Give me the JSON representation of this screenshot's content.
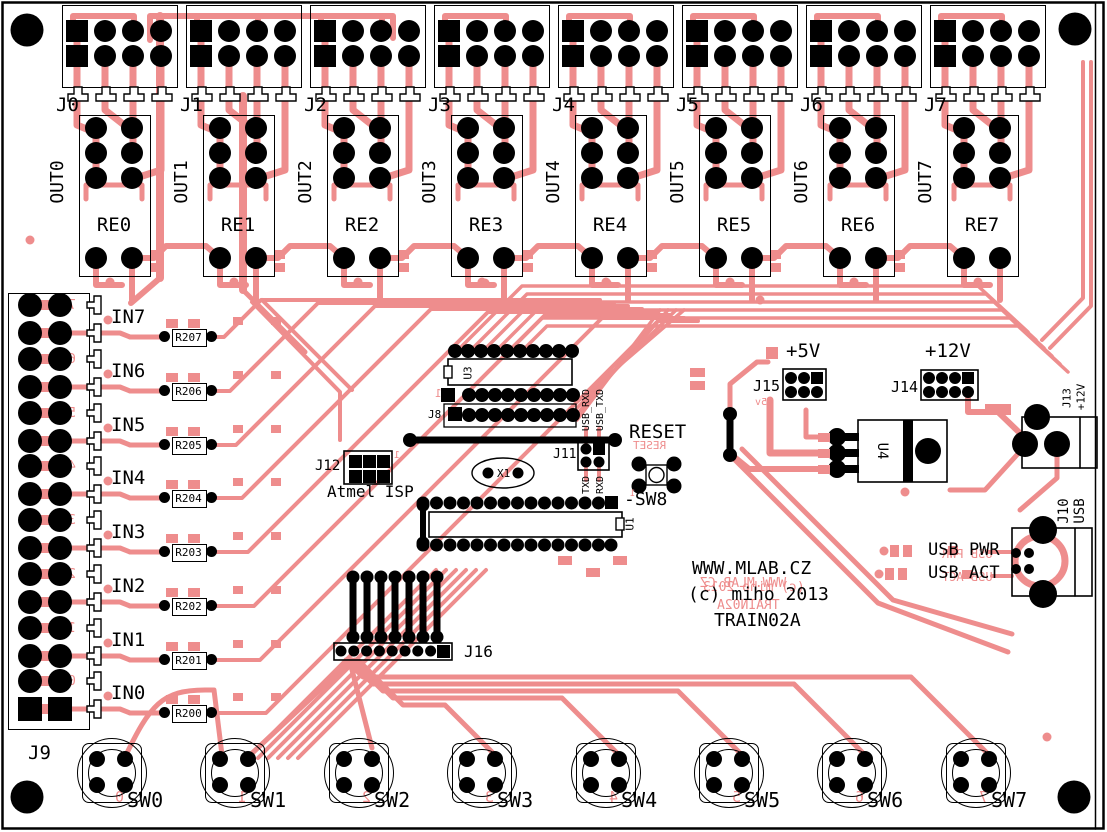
{
  "title_block": {
    "line1": "WWW.MLAB.CZ",
    "line2": "(c) miho 2013",
    "line3": "TRAIN02A"
  },
  "colors": {
    "copper": "#ee8d8d",
    "silkscreen": "#000000",
    "background": "#ffffff"
  },
  "output_channels": [
    {
      "connector": "J0",
      "net": "OUT0",
      "relay": "RE0"
    },
    {
      "connector": "J1",
      "net": "OUT1",
      "relay": "RE1"
    },
    {
      "connector": "J2",
      "net": "OUT2",
      "relay": "RE2"
    },
    {
      "connector": "J3",
      "net": "OUT3",
      "relay": "RE3"
    },
    {
      "connector": "J4",
      "net": "OUT4",
      "relay": "RE4"
    },
    {
      "connector": "J5",
      "net": "OUT5",
      "relay": "RE5"
    },
    {
      "connector": "J6",
      "net": "OUT6",
      "relay": "RE6"
    },
    {
      "connector": "J7",
      "net": "OUT7",
      "relay": "RE7"
    }
  ],
  "input_channels": [
    {
      "net": "IN7",
      "resistor": "R207",
      "pin_digit": "7"
    },
    {
      "net": "IN6",
      "resistor": "R206",
      "pin_digit": "6"
    },
    {
      "net": "IN5",
      "resistor": "R205",
      "pin_digit": "5"
    },
    {
      "net": "IN4",
      "resistor": "R204",
      "pin_digit": "4"
    },
    {
      "net": "IN3",
      "resistor": "R203",
      "pin_digit": "3"
    },
    {
      "net": "IN2",
      "resistor": "R202",
      "pin_digit": "2"
    },
    {
      "net": "IN1",
      "resistor": "R201",
      "pin_digit": "1"
    },
    {
      "net": "IN0",
      "resistor": "R200",
      "pin_digit": "0"
    }
  ],
  "input_connector": {
    "label": "J9"
  },
  "switches": [
    {
      "label": "SW0",
      "digit": "0"
    },
    {
      "label": "SW1",
      "digit": "1"
    },
    {
      "label": "SW2",
      "digit": "2"
    },
    {
      "label": "SW3",
      "digit": "3"
    },
    {
      "label": "SW4",
      "digit": "4"
    },
    {
      "label": "SW5",
      "digit": "5"
    },
    {
      "label": "SW6",
      "digit": "6"
    },
    {
      "label": "SW7",
      "digit": "7"
    }
  ],
  "mcu": {
    "u1": "U1",
    "u3": "U3",
    "j8": "J8",
    "pin1": "1"
  },
  "crystal": {
    "label": "X1"
  },
  "serial_header": {
    "label": "J11",
    "col_labels_top": [
      "USB_RXD",
      "USB_TXD"
    ],
    "col_labels_bottom": [
      "TXD",
      "RXD"
    ]
  },
  "isp_header": {
    "label": "J12",
    "pin1": "1",
    "caption": "Atmel ISP"
  },
  "reset": {
    "label": "RESET",
    "switch_label": "-SW8",
    "pin1": "1"
  },
  "aux_header": {
    "label": "J16"
  },
  "power": {
    "p5": {
      "net": "+5V",
      "header": "J15",
      "mirror": "+5v"
    },
    "p12": {
      "net": "+12V",
      "header": "J14"
    },
    "regulator": {
      "label": "U4"
    },
    "dc_jack": {
      "label": "J13",
      "net": "+12V"
    }
  },
  "usb": {
    "connector": "J10",
    "type": "USB",
    "led_pwr": "USB PWR",
    "led_act": "USB ACT"
  }
}
